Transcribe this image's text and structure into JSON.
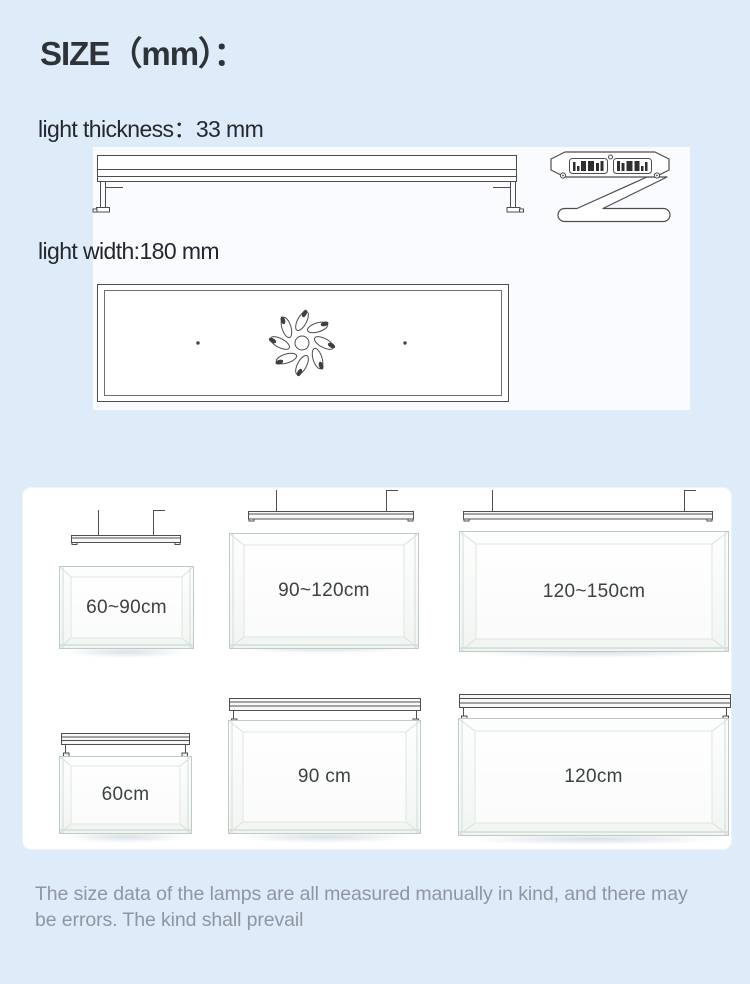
{
  "texts": {
    "title": "SIZE（mm）：",
    "thickness_label": "light thickness：33 mm",
    "width_label": "light width:180 mm",
    "disclaimer": "The size data of the lamps are all measured manually in kind, and there may be errors. The kind shall prevail"
  },
  "colors": {
    "page_background": "#deebf8",
    "panel_background": "#ffffff",
    "drawing_strip_background": "#f9fbfe",
    "drawing_line": "#4d4d4d",
    "tank_edge": "#bccbc3",
    "tank_label_text": "#3d4144",
    "heading_text": "#2e3338",
    "disclaimer_text": "#8f969f"
  },
  "diagrams": {
    "front_view": "lamp-front-view-drawing",
    "bracket_view": "lamp-z-bracket-side-drawing",
    "top_view": "lamp-top-view-drawing",
    "hanging_mount": "hanging-lamp-drawing",
    "stand_mount": "mounted-lamp-drawing"
  },
  "tanks": {
    "hanging_row": [
      {
        "label": "60~90cm"
      },
      {
        "label": "90~120cm"
      },
      {
        "label": "120~150cm"
      }
    ],
    "mounted_row": [
      {
        "label": "60cm"
      },
      {
        "label": "90 cm"
      },
      {
        "label": "120cm"
      }
    ]
  }
}
